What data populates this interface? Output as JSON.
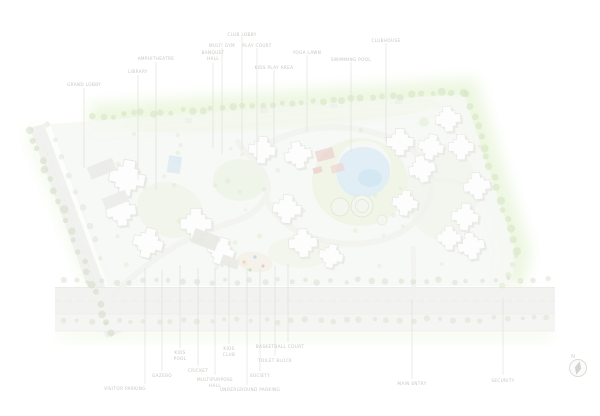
{
  "plan_type": "residential-site-master-plan",
  "colors": {
    "background": "#ffffff",
    "landscape_glow": "#d5ecba",
    "site_fill": "#f2f4ee",
    "road_fill": "#ebece7",
    "tree_green": "#bfd6a2",
    "pool_blue": "#c9e2f1",
    "clubhouse_roof_red": "#e2b6b2",
    "building_white": "#fdfdfc",
    "leader_line": "#c8c9c3",
    "label_text": "#c6c8c0"
  },
  "labels": {
    "top": [
      {
        "text": "GRAND LOBBY"
      },
      {
        "text": "LIBRARY"
      },
      {
        "text": "AMPHITHEATRE"
      },
      {
        "text": "BANQUET\nHALL"
      },
      {
        "text": "MULTI GYM"
      },
      {
        "text": "CLUB LOBBY"
      },
      {
        "text": "PLAY COURT"
      },
      {
        "text": "KIDS PLAY AREA"
      },
      {
        "text": "YOGA LAWN"
      },
      {
        "text": "SWIMMING POOL"
      },
      {
        "text": "CLUBHOUSE"
      }
    ],
    "bottom": [
      {
        "text": "VISITOR PARKING"
      },
      {
        "text": "GAZEBO"
      },
      {
        "text": "KIDS\nPOOL"
      },
      {
        "text": "CRICKET"
      },
      {
        "text": "MULTIPURPOSE\nHALL"
      },
      {
        "text": "KIDS\nCLUB"
      },
      {
        "text": "UNDERGROUND PARKING"
      },
      {
        "text": "SOCIETY"
      },
      {
        "text": "TOILET BLOCK"
      },
      {
        "text": "BASKETBALL COURT"
      },
      {
        "text": "MAIN ENTRY"
      },
      {
        "text": "SECURITY"
      }
    ]
  },
  "compass": {
    "north_label": "N",
    "icon": "north-compass"
  }
}
